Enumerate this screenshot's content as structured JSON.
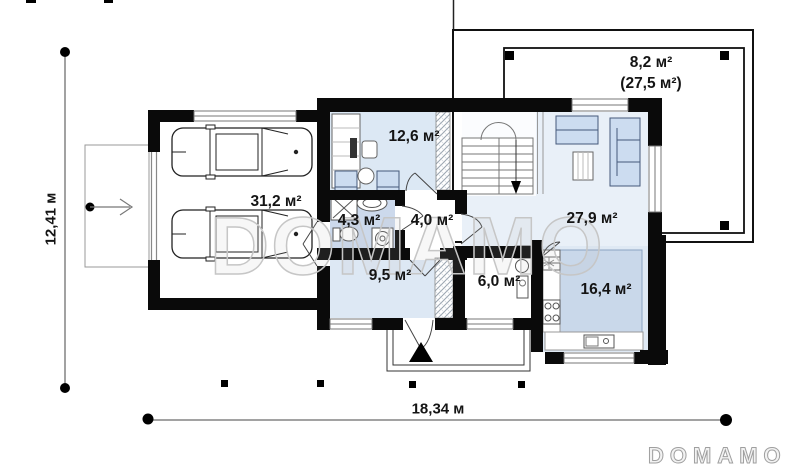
{
  "watermark_text": "DOMAMO",
  "logo_text": "DOMAMO",
  "dimensions": {
    "overall_width": "18,34 м",
    "overall_height": "12,41 м"
  },
  "rooms": {
    "garage": {
      "area": "31,2 м²"
    },
    "office": {
      "area": "12,6 м²"
    },
    "bathroom": {
      "area": "4,3 м²"
    },
    "hall": {
      "area": "4,0 м²"
    },
    "living_room": {
      "area": "27,9 м²"
    },
    "hallway": {
      "area": "9,5 м²"
    },
    "vestibule": {
      "area": "6,0 м²"
    },
    "kitchen": {
      "area": "16,4 м²"
    },
    "terrace": {
      "area": "8,2 м²",
      "area_total": "(27,5 м²)"
    }
  },
  "colors": {
    "wall": "#0a0a0a",
    "floor_blue": "#dde8f4",
    "floor_blue_light": "#e9f0f8",
    "bath_blue": "#ccd9ec",
    "kitchen_zone": "#c9d8ea",
    "furniture_blue": "#ccdcf0",
    "watermark_gray": "#c6c6c6"
  }
}
